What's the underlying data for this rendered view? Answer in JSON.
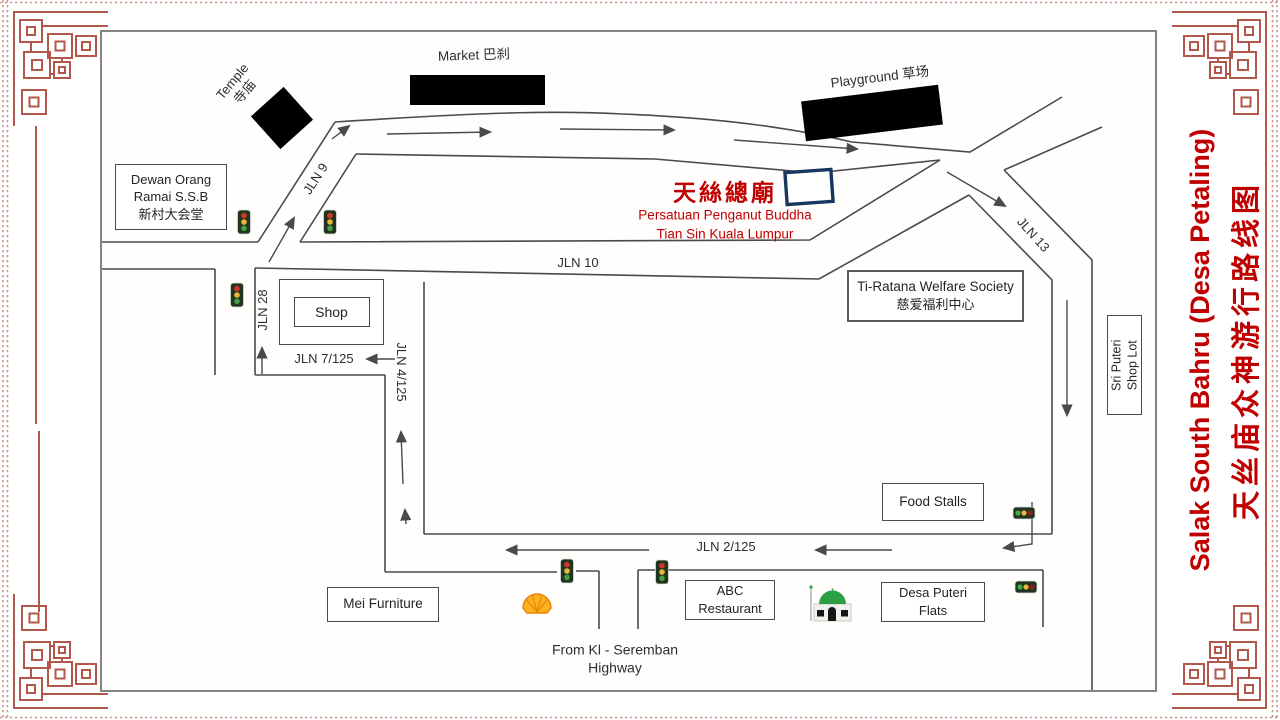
{
  "page_title": {
    "english": "Salak South Bahru (Desa Petaling)",
    "chinese": "天丝庙众神游行路线图"
  },
  "destination": {
    "title": "天絲總廟",
    "line2": "Persatuan Penganut Buddha",
    "line3": "Tian Sin Kuala Lumpur"
  },
  "landmarks": {
    "dewan": {
      "line1": "Dewan Orang",
      "line2": "Ramai S.S.B",
      "line3": "新村大会堂"
    },
    "temple": {
      "line1": "Temple",
      "line2": "寺庙"
    },
    "market": {
      "label": "Market 巴刹"
    },
    "playground": {
      "label": "Playground 草场"
    },
    "shop": {
      "label": "Shop"
    },
    "ti_ratana": {
      "line1": "Ti-Ratana  Welfare Society",
      "line2": "慈爱福利中心"
    },
    "sri_puteri": {
      "line1": "Sri Puteri",
      "line2": "Shop Lot"
    },
    "food_stalls": {
      "label": "Food Stalls"
    },
    "mei_furniture": {
      "label": "Mei Furniture"
    },
    "abc_restaurant": {
      "line1": "ABC",
      "line2": "Restaurant"
    },
    "desa_puteri": {
      "line1": "Desa Puteri",
      "line2": "Flats"
    },
    "highway": {
      "line1": "From Kl - Seremban",
      "line2": "Highway"
    }
  },
  "roads": {
    "jln9": "JLN 9",
    "jln10": "JLN 10",
    "jln13": "JLN 13",
    "jln28": "JLN 28",
    "jln7_125": "JLN 7/125",
    "jln4_125": "JLN 4/125",
    "jln2_125": "JLN 2/125"
  },
  "icons": {
    "traffic_light": "traffic-light",
    "shell": "shell-petrol-station",
    "mosque": "mosque",
    "route_arrow": "direction-arrow"
  },
  "colors": {
    "accent_red": "#c00000",
    "road_line": "#4a4a4a",
    "frame_ornament": "#b3574c",
    "temple_outline": "#17375e",
    "building_black": "#000000"
  }
}
